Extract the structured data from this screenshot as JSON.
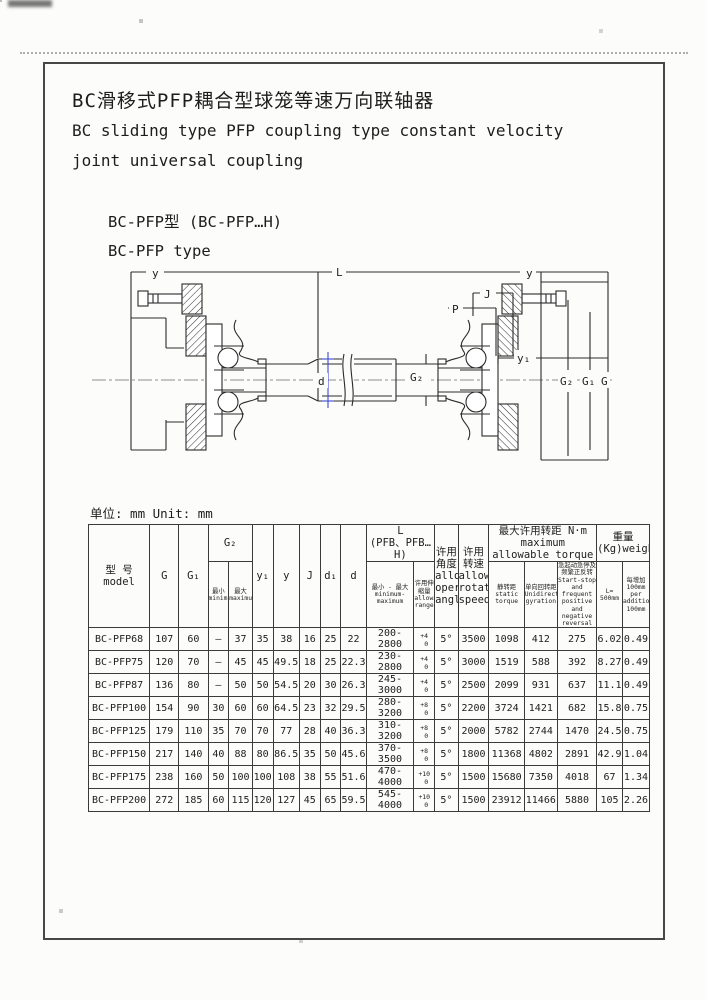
{
  "header_block": {
    "title_zh": "BC滑移式PFP耦合型球笼等速万向联轴器",
    "title_en_1": "BC sliding type PFP coupling type constant velocity",
    "title_en_2": "joint universal coupling",
    "model_zh": "BC-PFP型  (BC-PFP…H)",
    "model_en": "BC-PFP type"
  },
  "unit_note": "单位: mm Unit: mm",
  "drawing": {
    "accent_blue": "#3d4bd6",
    "labels": {
      "dim_y_left": "y",
      "dim_l": "L",
      "dim_y_right": "y",
      "dim_j": "J",
      "dim_p": "P",
      "dim_y1": "y₁",
      "dim_d": "d",
      "dim_g2_shaft": "G₂",
      "dim_g2": "G₂",
      "dim_g1": "G₁",
      "dim_g": "G"
    }
  },
  "table": {
    "header": {
      "model": "型 号\nmodel",
      "g": "G",
      "g1": "G₁",
      "g2_group": "G₂",
      "g2_min": "最小\nminimum",
      "g2_max": "最大\nmaximum",
      "y1": "y₁",
      "y": "y",
      "j": "J",
      "d1": "d₁",
      "d": "d",
      "l_group": "L\n(PFB、PFB…H)",
      "l_minmax": "最小 - 最大\nminimum-maximum",
      "l_range": "许用伸缩量\nallowable\nrange",
      "angle": "许用角度\nallowable\noperation\nangle",
      "speed": "许用转速\nallowable\nrotation\nspeed",
      "torque_group": "最大许用转距 N·m\nmaximum allowable torque",
      "torque_static": "静转距\nstatic torque",
      "torque_unidirectional": "单向回转距\nUnidirectional\ngyration",
      "torque_startstop": "急起动急停及频繁正反转\nStart-stop and frequent\npositive and negative reversal",
      "weight_group": "重量 (Kg)weight",
      "weight_l500": "L=\n500mm",
      "weight_per100": "每增加 100mm\nper additional\n100mm"
    },
    "rows": [
      [
        "BC-PFP68",
        "107",
        "60",
        "—",
        "37",
        "35",
        "38",
        "16",
        "25",
        "22",
        "200-2800",
        "+4|0",
        "5°",
        "3500",
        "1098",
        "412",
        "275",
        "6.02",
        "0.49"
      ],
      [
        "BC-PFP75",
        "120",
        "70",
        "—",
        "45",
        "45",
        "49.5",
        "18",
        "25",
        "22.3",
        "230-2800",
        "+4|0",
        "5°",
        "3000",
        "1519",
        "588",
        "392",
        "8.27",
        "0.49"
      ],
      [
        "BC-PFP87",
        "136",
        "80",
        "—",
        "50",
        "50",
        "54.5",
        "20",
        "30",
        "26.3",
        "245-3000",
        "+4|0",
        "5°",
        "2500",
        "2099",
        "931",
        "637",
        "11.1",
        "0.49"
      ],
      [
        "BC-PFP100",
        "154",
        "90",
        "30",
        "60",
        "60",
        "64.5",
        "23",
        "32",
        "29.5",
        "280-3200",
        "+8|0",
        "5°",
        "2200",
        "3724",
        "1421",
        "682",
        "15.8",
        "0.75"
      ],
      [
        "BC-PFP125",
        "179",
        "110",
        "35",
        "70",
        "70",
        "77",
        "28",
        "40",
        "36.3",
        "310-3200",
        "+8|0",
        "5°",
        "2000",
        "5782",
        "2744",
        "1470",
        "24.5",
        "0.75"
      ],
      [
        "BC-PFP150",
        "217",
        "140",
        "40",
        "88",
        "80",
        "86.5",
        "35",
        "50",
        "45.6",
        "370-3500",
        "+8|0",
        "5°",
        "1800",
        "11368",
        "4802",
        "2891",
        "42.9",
        "1.04"
      ],
      [
        "BC-PFP175",
        "238",
        "160",
        "50",
        "100",
        "100",
        "108",
        "38",
        "55",
        "51.6",
        "470-4000",
        "+10|0",
        "5°",
        "1500",
        "15680",
        "7350",
        "4018",
        "67",
        "1.34"
      ],
      [
        "BC-PFP200",
        "272",
        "185",
        "60",
        "115",
        "120",
        "127",
        "45",
        "65",
        "59.5",
        "545-4000",
        "+10|0",
        "5°",
        "1500",
        "23912",
        "11466",
        "5880",
        "105",
        "2.26"
      ]
    ]
  }
}
